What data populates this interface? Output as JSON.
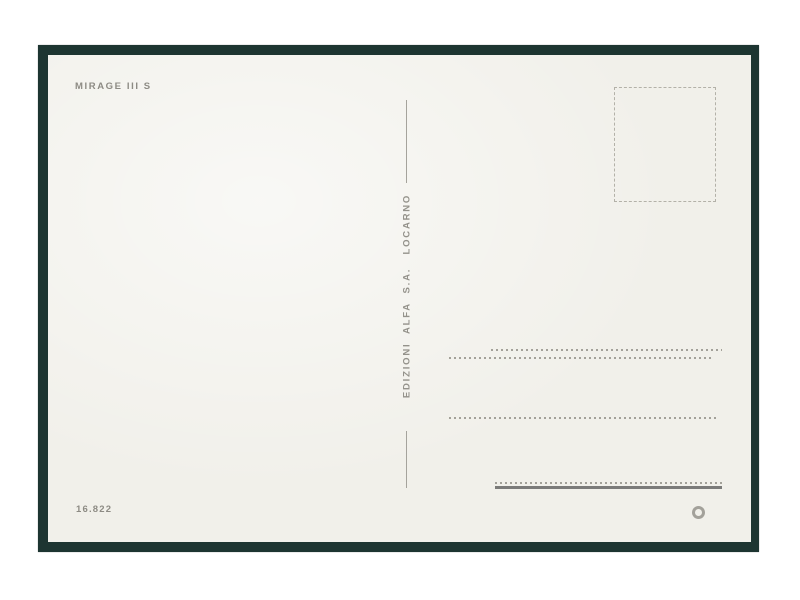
{
  "postcard": {
    "title": "MIRAGE III S",
    "publisher_imprint": "EDIZIONI  ALFA  S.A.   LOCARNO",
    "catalog_number": "16.822",
    "copyright_mark": "©"
  },
  "stamp_box": {
    "style": "dashed-outline",
    "purpose": "stamp placement area"
  },
  "address_area": {
    "dotted_line_count": 4,
    "has_bottom_solid_rule": true
  },
  "colors": {
    "frame": "#1d3531",
    "card": "#f1f0ea",
    "print_text": "#8d8b84",
    "dotted_line": "#a3a199",
    "solid_rule": "#7b7b79",
    "background": "#ffffff"
  }
}
